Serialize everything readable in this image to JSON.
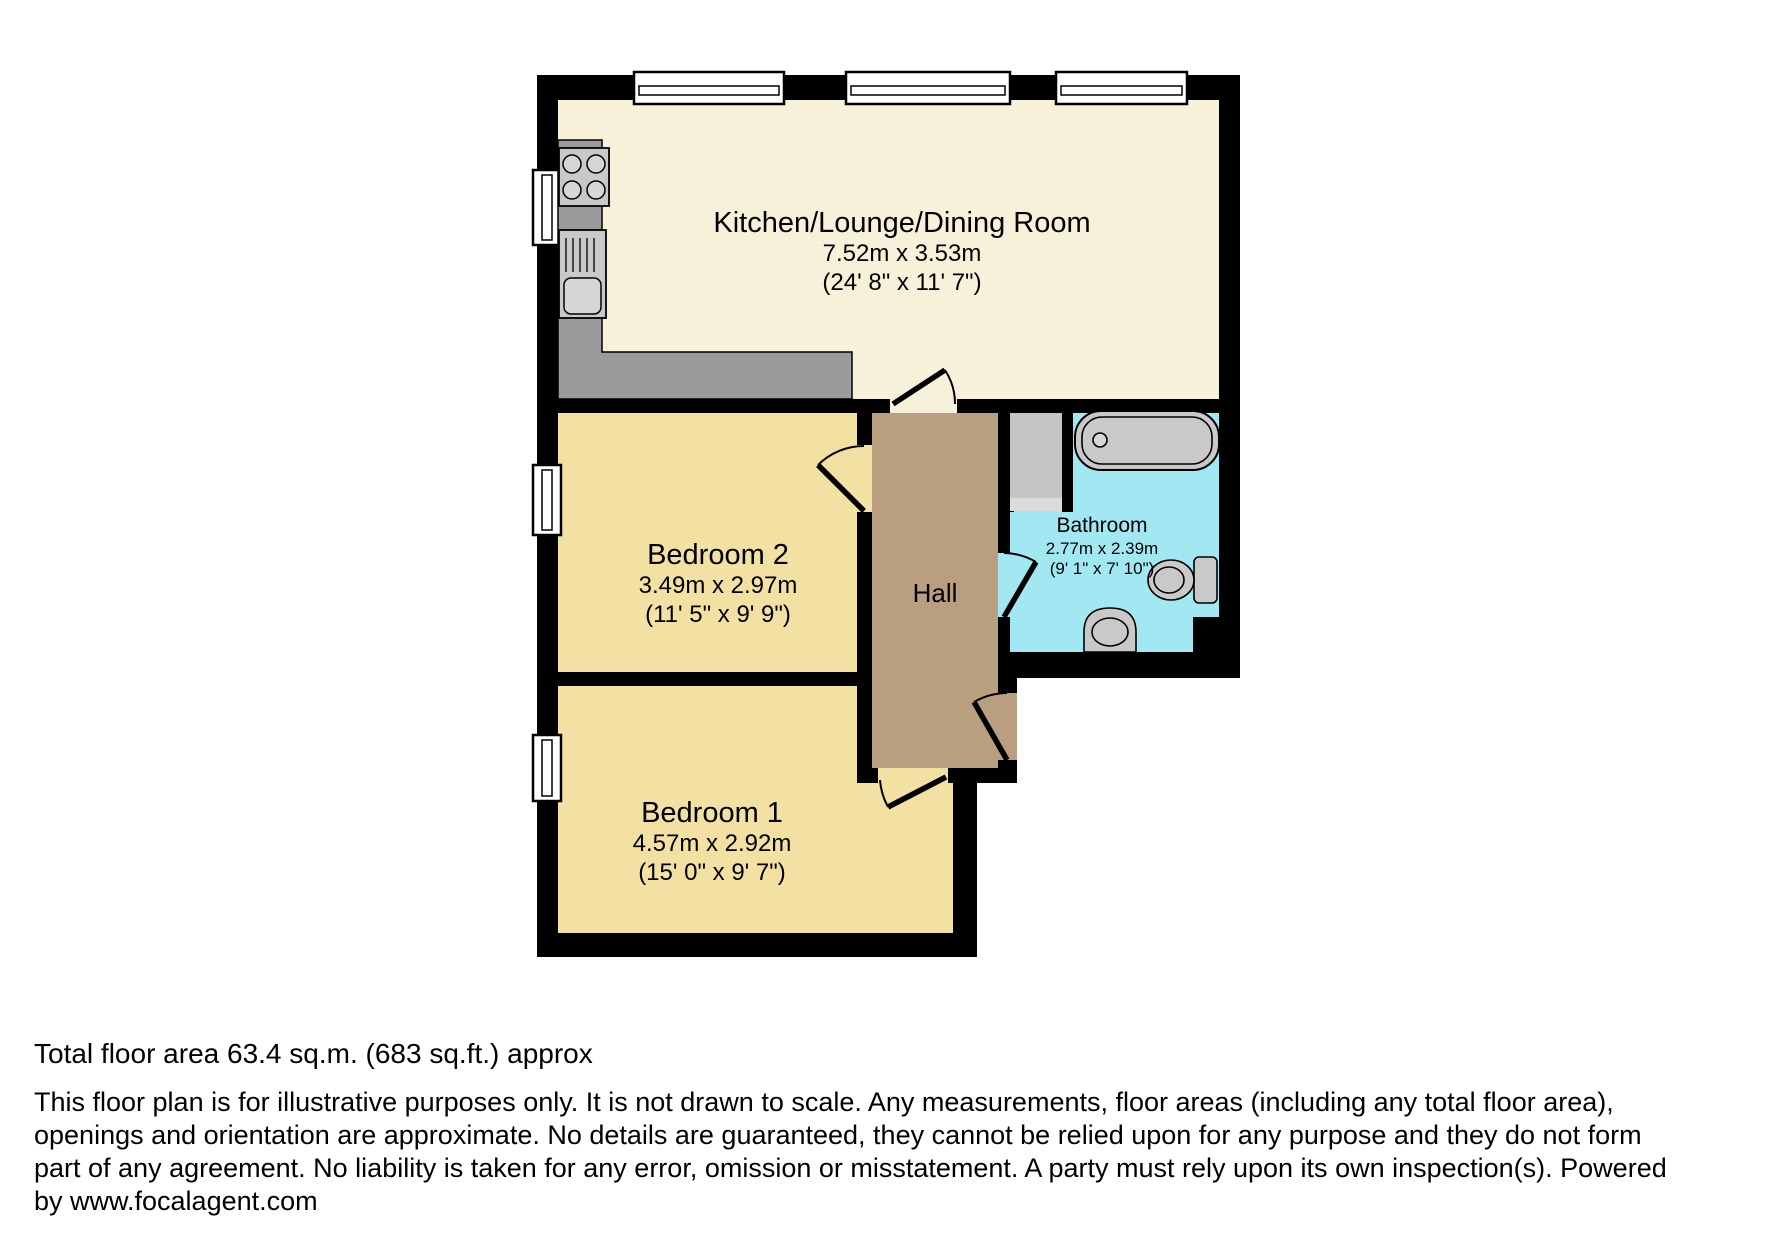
{
  "plan": {
    "rooms": [
      {
        "id": "kitchen",
        "name": "Kitchen/Lounge/Dining Room",
        "dim_metric": "7.52m x 3.53m",
        "dim_imperial": "(24' 8\" x 11' 7\")"
      },
      {
        "id": "bedroom2",
        "name": "Bedroom 2",
        "dim_metric": "3.49m x 2.97m",
        "dim_imperial": "(11' 5\" x 9' 9\")"
      },
      {
        "id": "bedroom1",
        "name": "Bedroom 1",
        "dim_metric": "4.57m x 2.92m",
        "dim_imperial": "(15' 0\" x 9' 7\")"
      },
      {
        "id": "bathroom",
        "name": "Bathroom",
        "dim_metric": "2.77m x 2.39m",
        "dim_imperial": "(9' 1\" x 7' 10\")"
      },
      {
        "id": "hall",
        "name": "Hall"
      }
    ],
    "colors": {
      "wall": "#000000",
      "kitchen_floor": "#F8F1DA",
      "bedroom_floor": "#F3E1A3",
      "hall_floor": "#BA9E80",
      "bathroom_floor": "#A2E8F3",
      "counter": "#9B9B9B",
      "fixture": "#C9C9C9",
      "fixture_light": "#D6D6D6",
      "cubicle": "#C5C5C5",
      "cubicle_sill": "#DCDCDC",
      "window": "#FFFFFF"
    }
  },
  "footer": {
    "total_area": "Total floor area 63.4 sq.m. (683 sq.ft.) approx",
    "disclaimer_lines": [
      "This floor plan is for illustrative purposes only. It is not drawn to scale. Any measurements, floor areas (including any total floor area),",
      "openings and orientation are approximate. No details are guaranteed, they cannot be relied upon for any purpose and they do not form",
      "part of any agreement. No liability is taken for any error, omission or misstatement. A party must rely upon its own inspection(s). Powered",
      "by www.focalagent.com"
    ]
  }
}
